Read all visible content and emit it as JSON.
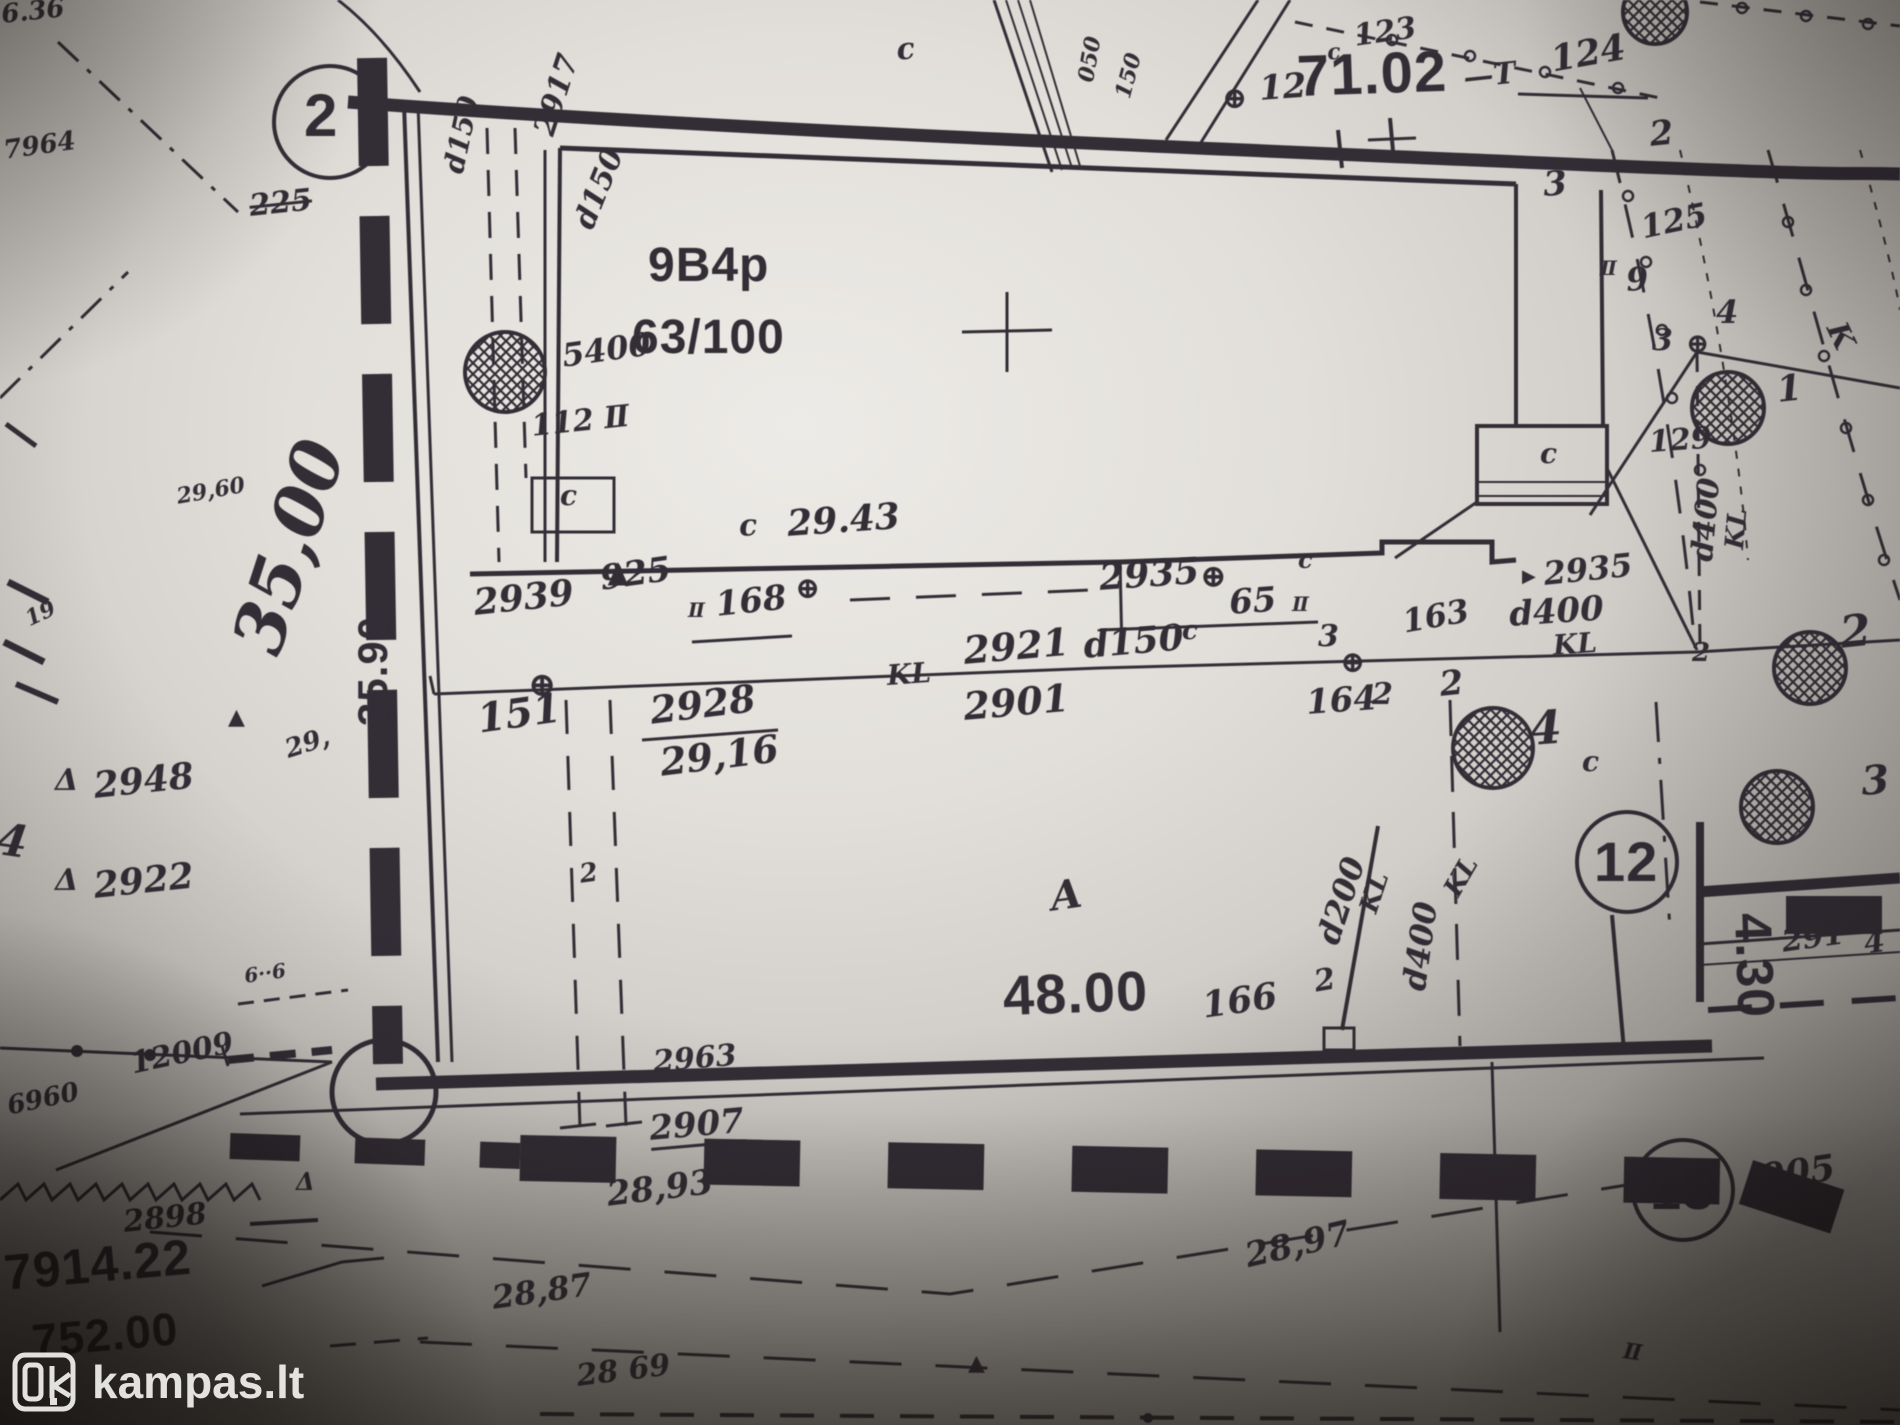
{
  "watermark": {
    "brand": "kampas.lt"
  },
  "map": {
    "labels": [
      {
        "name": "frag-top-left",
        "text": "6.36",
        "x": 0,
        "y": 2,
        "size": 26,
        "rot": -6,
        "cls": "h"
      },
      {
        "name": "frag-7964",
        "text": "7964",
        "x": 2,
        "y": 138,
        "size": 26,
        "rot": -8,
        "cls": "h"
      },
      {
        "name": "point-circle-2",
        "text": "2",
        "x": 304,
        "y": 86,
        "size": 60,
        "rot": 0,
        "cls": "p"
      },
      {
        "name": "scribble-225",
        "text": "225",
        "x": 248,
        "y": 192,
        "size": 30,
        "rot": -6,
        "cls": "h strike"
      },
      {
        "name": "pipe-d150-a",
        "text": "d150",
        "x": 440,
        "y": 170,
        "size": 28,
        "rot": -78,
        "cls": "h"
      },
      {
        "name": "pipe-d150-b",
        "text": "d150",
        "x": 570,
        "y": 222,
        "size": 30,
        "rot": -68,
        "cls": "h"
      },
      {
        "name": "mark-2917",
        "text": "2917",
        "x": 530,
        "y": 130,
        "size": 30,
        "rot": -72,
        "cls": "h"
      },
      {
        "name": "mark-5400",
        "text": "5400",
        "x": 560,
        "y": 340,
        "size": 32,
        "rot": -8,
        "cls": "h"
      },
      {
        "name": "mark-112",
        "text": "112 Ⅱ",
        "x": 530,
        "y": 412,
        "size": 30,
        "rot": -6,
        "cls": "h"
      },
      {
        "name": "shed-c",
        "text": "c",
        "x": 560,
        "y": 482,
        "size": 28,
        "rot": 0,
        "cls": "h"
      },
      {
        "name": "parcel-code",
        "text": "9B4p",
        "x": 648,
        "y": 242,
        "size": 48,
        "rot": 0,
        "cls": "p"
      },
      {
        "name": "parcel-share",
        "text": "63/100",
        "x": 632,
        "y": 314,
        "size": 48,
        "rot": 0,
        "cls": "p"
      },
      {
        "name": "mark-c-top",
        "text": "c",
        "x": 895,
        "y": 36,
        "size": 30,
        "rot": -6,
        "cls": "h"
      },
      {
        "name": "mark-c-123",
        "text": "c",
        "x": 1326,
        "y": 42,
        "size": 22,
        "rot": -6,
        "cls": "h"
      },
      {
        "name": "mark-123",
        "text": "123",
        "x": 1352,
        "y": 22,
        "size": 30,
        "rot": -8,
        "cls": "h"
      },
      {
        "name": "oplus-12",
        "text": "⊕",
        "x": 1222,
        "y": 84,
        "size": 30,
        "rot": 0,
        "cls": "h"
      },
      {
        "name": "mark-12-small",
        "text": "12",
        "x": 1258,
        "y": 72,
        "size": 34,
        "rot": -4,
        "cls": "h"
      },
      {
        "name": "elev-7102",
        "text": "71.02",
        "x": 1296,
        "y": 48,
        "size": 58,
        "rot": -2,
        "cls": "p"
      },
      {
        "name": "mark-dash-T",
        "text": "—T",
        "x": 1462,
        "y": 64,
        "size": 30,
        "rot": -6,
        "cls": "h"
      },
      {
        "name": "mark-124",
        "text": "124",
        "x": 1548,
        "y": 42,
        "size": 36,
        "rot": -10,
        "cls": "h"
      },
      {
        "name": "mark-2-tr",
        "text": "2",
        "x": 1648,
        "y": 118,
        "size": 34,
        "rot": -6,
        "cls": "h"
      },
      {
        "name": "mark-3-tr",
        "text": "3",
        "x": 1542,
        "y": 168,
        "size": 34,
        "rot": -4,
        "cls": "h"
      },
      {
        "name": "mark-125",
        "text": "125",
        "x": 1638,
        "y": 212,
        "size": 32,
        "rot": -12,
        "cls": "h"
      },
      {
        "name": "mark-ii-9",
        "text": "Ⅱ",
        "x": 1600,
        "y": 258,
        "size": 20,
        "rot": 0,
        "cls": "h"
      },
      {
        "name": "mark-9",
        "text": "9",
        "x": 1625,
        "y": 264,
        "size": 32,
        "rot": -4,
        "cls": "h"
      },
      {
        "name": "mark-4-r",
        "text": "4",
        "x": 1716,
        "y": 296,
        "size": 32,
        "rot": 0,
        "cls": "h"
      },
      {
        "name": "mark-3-r",
        "text": "3",
        "x": 1652,
        "y": 326,
        "size": 30,
        "rot": 0,
        "cls": "h"
      },
      {
        "name": "oplus-junction-r",
        "text": "⊕",
        "x": 1686,
        "y": 330,
        "size": 28,
        "rot": 0,
        "cls": "h"
      },
      {
        "name": "mark-1-r",
        "text": "1",
        "x": 1775,
        "y": 372,
        "size": 36,
        "rot": -6,
        "cls": "h"
      },
      {
        "name": "mark-K-r",
        "text": "K",
        "x": 1848,
        "y": 318,
        "size": 30,
        "rot": 65,
        "cls": "h"
      },
      {
        "name": "mark-129",
        "text": "129",
        "x": 1648,
        "y": 428,
        "size": 30,
        "rot": -4,
        "cls": "h"
      },
      {
        "name": "annex-c",
        "text": "c",
        "x": 1540,
        "y": 440,
        "size": 28,
        "rot": 0,
        "cls": "h"
      },
      {
        "name": "mark-2939",
        "text": "2939",
        "x": 472,
        "y": 585,
        "size": 36,
        "rot": -6,
        "cls": "h"
      },
      {
        "name": "mark-925",
        "text": "925",
        "x": 598,
        "y": 562,
        "size": 34,
        "rot": -8,
        "cls": "h"
      },
      {
        "name": "mark-ii-168",
        "text": "Ⅱ",
        "x": 688,
        "y": 600,
        "size": 20,
        "rot": 0,
        "cls": "h"
      },
      {
        "name": "mark-168",
        "text": "168",
        "x": 714,
        "y": 588,
        "size": 34,
        "rot": -6,
        "cls": "h"
      },
      {
        "name": "oplus-a",
        "text": "⊕",
        "x": 795,
        "y": 574,
        "size": 30,
        "rot": 0,
        "cls": "h"
      },
      {
        "name": "mark-2935-c",
        "text": "2935",
        "x": 1098,
        "y": 560,
        "size": 36,
        "rot": -4,
        "cls": "h"
      },
      {
        "name": "oplus-b",
        "text": "⊕",
        "x": 1200,
        "y": 560,
        "size": 32,
        "rot": 0,
        "cls": "h"
      },
      {
        "name": "mark-65",
        "text": "65",
        "x": 1228,
        "y": 586,
        "size": 34,
        "rot": -4,
        "cls": "h"
      },
      {
        "name": "mark-ii-65",
        "text": "Ⅱ",
        "x": 1292,
        "y": 594,
        "size": 20,
        "rot": 0,
        "cls": "h"
      },
      {
        "name": "mark-c-65",
        "text": "c",
        "x": 1298,
        "y": 548,
        "size": 24,
        "rot": 0,
        "cls": "h"
      },
      {
        "name": "dim-c-2943",
        "text": "c",
        "x": 738,
        "y": 512,
        "size": 30,
        "rot": -4,
        "cls": "h"
      },
      {
        "name": "dim-2943",
        "text": "29.43",
        "x": 786,
        "y": 506,
        "size": 36,
        "rot": -4,
        "cls": "h"
      },
      {
        "name": "mark-2921",
        "text": "2921",
        "x": 962,
        "y": 632,
        "size": 38,
        "rot": -5,
        "cls": "h"
      },
      {
        "name": "pipe-d150-c",
        "text": "d150",
        "x": 1082,
        "y": 628,
        "size": 36,
        "rot": -5,
        "cls": "h"
      },
      {
        "name": "mark-c-2921",
        "text": "c",
        "x": 1182,
        "y": 618,
        "size": 26,
        "rot": 0,
        "cls": "h"
      },
      {
        "name": "mark-KL-a",
        "text": "KL",
        "x": 886,
        "y": 662,
        "size": 28,
        "rot": -4,
        "cls": "h"
      },
      {
        "name": "mark-2901",
        "text": "2901",
        "x": 962,
        "y": 688,
        "size": 38,
        "rot": -5,
        "cls": "h"
      },
      {
        "name": "mark-3-kl",
        "text": "3",
        "x": 1318,
        "y": 622,
        "size": 30,
        "rot": 0,
        "cls": "h"
      },
      {
        "name": "oplus-c",
        "text": "⊕",
        "x": 1340,
        "y": 648,
        "size": 30,
        "rot": 0,
        "cls": "h"
      },
      {
        "name": "mark-164",
        "text": "164",
        "x": 1305,
        "y": 686,
        "size": 34,
        "rot": -4,
        "cls": "h"
      },
      {
        "name": "mark-2-164",
        "text": "2",
        "x": 1372,
        "y": 680,
        "size": 30,
        "rot": 0,
        "cls": "h"
      },
      {
        "name": "mark-163",
        "text": "163",
        "x": 1400,
        "y": 606,
        "size": 32,
        "rot": -10,
        "cls": "h"
      },
      {
        "name": "tri-2935",
        "text": "▶",
        "x": 1522,
        "y": 568,
        "size": 18,
        "rot": 0,
        "cls": "h"
      },
      {
        "name": "mark-2935-r",
        "text": "2935",
        "x": 1542,
        "y": 558,
        "size": 32,
        "rot": -6,
        "cls": "h"
      },
      {
        "name": "pipe-d400-r",
        "text": "d400",
        "x": 1508,
        "y": 598,
        "size": 34,
        "rot": -4,
        "cls": "h"
      },
      {
        "name": "mark-KL-b",
        "text": "KL",
        "x": 1552,
        "y": 632,
        "size": 28,
        "rot": -4,
        "cls": "h"
      },
      {
        "name": "mark-2-kl",
        "text": "2",
        "x": 1692,
        "y": 640,
        "size": 26,
        "rot": 0,
        "cls": "h"
      },
      {
        "name": "mark-2-big-r",
        "text": "2",
        "x": 1838,
        "y": 612,
        "size": 44,
        "rot": -6,
        "cls": "h"
      },
      {
        "name": "pipe-d400-rot",
        "text": "d400",
        "x": 1688,
        "y": 560,
        "size": 30,
        "rot": -85,
        "cls": "h"
      },
      {
        "name": "mark-KL-rot",
        "text": "KL",
        "x": 1722,
        "y": 548,
        "size": 26,
        "rot": -85,
        "cls": "h"
      },
      {
        "name": "mark-151",
        "text": "151",
        "x": 475,
        "y": 700,
        "size": 40,
        "rot": -8,
        "cls": "h"
      },
      {
        "name": "mark-2928",
        "text": "2928",
        "x": 648,
        "y": 692,
        "size": 38,
        "rot": -7,
        "cls": "h"
      },
      {
        "name": "mark-2916",
        "text": "29,16",
        "x": 658,
        "y": 744,
        "size": 38,
        "rot": -7,
        "cls": "h"
      },
      {
        "name": "dim-3500-hand",
        "text": "35,00",
        "x": 222,
        "y": 640,
        "size": 70,
        "rot": -72,
        "cls": "h"
      },
      {
        "name": "mark-2960",
        "text": "29,60",
        "x": 175,
        "y": 486,
        "size": 22,
        "rot": -10,
        "cls": "h"
      },
      {
        "name": "mark-29",
        "text": "29,",
        "x": 282,
        "y": 738,
        "size": 26,
        "rot": -18,
        "cls": "h"
      },
      {
        "name": "tri-a",
        "text": "▲",
        "x": 228,
        "y": 706,
        "size": 22,
        "rot": 0,
        "cls": "h"
      },
      {
        "name": "delta-2948",
        "text": "Δ",
        "x": 55,
        "y": 766,
        "size": 30,
        "rot": 0,
        "cls": "h"
      },
      {
        "name": "mark-2948",
        "text": "2948",
        "x": 92,
        "y": 768,
        "size": 36,
        "rot": -6,
        "cls": "h"
      },
      {
        "name": "delta-2922",
        "text": "Δ",
        "x": 55,
        "y": 866,
        "size": 30,
        "rot": 0,
        "cls": "h"
      },
      {
        "name": "mark-2922",
        "text": "2922",
        "x": 92,
        "y": 868,
        "size": 36,
        "rot": -6,
        "cls": "h"
      },
      {
        "name": "mark-19",
        "text": "19",
        "x": 22,
        "y": 610,
        "size": 22,
        "rot": -25,
        "cls": "h"
      },
      {
        "name": "scribble-4-edge",
        "text": "4",
        "x": 0,
        "y": 818,
        "size": 44,
        "rot": 8,
        "cls": "h"
      },
      {
        "name": "dim-3590-print",
        "text": "35.90",
        "x": 352,
        "y": 726,
        "size": 42,
        "rot": -90,
        "cls": "p"
      },
      {
        "name": "zone-A",
        "text": "A",
        "x": 1048,
        "y": 878,
        "size": 40,
        "rot": -8,
        "cls": "h"
      },
      {
        "name": "dim-4800",
        "text": "48.00",
        "x": 1002,
        "y": 968,
        "size": 56,
        "rot": -2,
        "cls": "p"
      },
      {
        "name": "mark-166",
        "text": "166",
        "x": 1200,
        "y": 988,
        "size": 36,
        "rot": -8,
        "cls": "h"
      },
      {
        "name": "mark-2-166",
        "text": "2",
        "x": 1312,
        "y": 968,
        "size": 30,
        "rot": -10,
        "cls": "h"
      },
      {
        "name": "pipe-d200-rot",
        "text": "d200",
        "x": 1312,
        "y": 938,
        "size": 32,
        "rot": -72,
        "cls": "h"
      },
      {
        "name": "mark-KL-rot-c",
        "text": "KL",
        "x": 1356,
        "y": 908,
        "size": 26,
        "rot": -72,
        "cls": "h"
      },
      {
        "name": "pipe-d400-rot2",
        "text": "d400",
        "x": 1398,
        "y": 988,
        "size": 32,
        "rot": -82,
        "cls": "h"
      },
      {
        "name": "mark-KL-rot-d",
        "text": "KL",
        "x": 1440,
        "y": 888,
        "size": 26,
        "rot": -60,
        "cls": "h"
      },
      {
        "name": "mark-2963",
        "text": "2963",
        "x": 652,
        "y": 1048,
        "size": 30,
        "rot": -5,
        "cls": "h"
      },
      {
        "name": "mark-2907",
        "text": "2907",
        "x": 648,
        "y": 1112,
        "size": 34,
        "rot": -5,
        "cls": "h ul"
      },
      {
        "name": "mark-2893",
        "text": "28,93",
        "x": 605,
        "y": 1178,
        "size": 34,
        "rot": -7,
        "cls": "h"
      },
      {
        "name": "mark-2897",
        "text": "28,97",
        "x": 1242,
        "y": 1240,
        "size": 34,
        "rot": -13,
        "cls": "h"
      },
      {
        "name": "mark-12009",
        "text": "12009",
        "x": 128,
        "y": 1050,
        "size": 30,
        "rot": -12,
        "cls": "h"
      },
      {
        "name": "mark-6960",
        "text": "6960",
        "x": 5,
        "y": 1094,
        "size": 26,
        "rot": -12,
        "cls": "h"
      },
      {
        "name": "mark-2898",
        "text": "2898",
        "x": 122,
        "y": 1208,
        "size": 30,
        "rot": -6,
        "cls": "h"
      },
      {
        "name": "mark-791422",
        "text": "7914.22",
        "x": 2,
        "y": 1248,
        "size": 50,
        "rot": -5,
        "cls": "p"
      },
      {
        "name": "mark-75200",
        "text": "752.00",
        "x": 30,
        "y": 1318,
        "size": 46,
        "rot": -5,
        "cls": "p"
      },
      {
        "name": "mark-2887",
        "text": "28,87",
        "x": 490,
        "y": 1282,
        "size": 32,
        "rot": -8,
        "cls": "h"
      },
      {
        "name": "mark-2869",
        "text": "28 69",
        "x": 575,
        "y": 1362,
        "size": 30,
        "rot": -7,
        "cls": "h"
      },
      {
        "name": "tri-b",
        "text": "▲",
        "x": 968,
        "y": 1352,
        "size": 22,
        "rot": 0,
        "cls": "h"
      },
      {
        "name": "mark-ii-bottom",
        "text": "Ⅱ",
        "x": 1625,
        "y": 1340,
        "size": 22,
        "rot": 8,
        "cls": "h"
      },
      {
        "name": "point-circle-12",
        "text": "12",
        "x": 1594,
        "y": 834,
        "size": 56,
        "rot": 0,
        "cls": "p"
      },
      {
        "name": "point-circle-13",
        "text": "13",
        "x": 1650,
        "y": 1162,
        "size": 56,
        "rot": 0,
        "cls": "p"
      },
      {
        "name": "mark-905",
        "text": "905",
        "x": 1758,
        "y": 1160,
        "size": 36,
        "rot": -8,
        "cls": "h"
      },
      {
        "name": "dim-430",
        "text": "4.30",
        "x": 1778,
        "y": 912,
        "size": 52,
        "rot": 88,
        "cls": "p"
      },
      {
        "name": "mark-291",
        "text": "291",
        "x": 1780,
        "y": 928,
        "size": 30,
        "rot": -8,
        "cls": "h"
      },
      {
        "name": "mark-4-291",
        "text": "4",
        "x": 1862,
        "y": 930,
        "size": 30,
        "rot": -8,
        "cls": "h"
      },
      {
        "name": "mark-3-br",
        "text": "3",
        "x": 1860,
        "y": 762,
        "size": 40,
        "rot": -4,
        "cls": "h"
      },
      {
        "name": "mark-c-12",
        "text": "c",
        "x": 1582,
        "y": 748,
        "size": 28,
        "rot": 0,
        "cls": "h"
      },
      {
        "name": "mark-4-12",
        "text": "4",
        "x": 1528,
        "y": 706,
        "size": 46,
        "rot": -4,
        "cls": "h"
      },
      {
        "name": "mark-2-163",
        "text": "2",
        "x": 1438,
        "y": 668,
        "size": 34,
        "rot": -6,
        "cls": "h"
      },
      {
        "name": "oplus-e",
        "text": "⊕",
        "x": 528,
        "y": 668,
        "size": 34,
        "rot": 0,
        "cls": "h"
      },
      {
        "name": "mark-2-pipe",
        "text": "2",
        "x": 578,
        "y": 862,
        "size": 26,
        "rot": -8,
        "cls": "h"
      },
      {
        "name": "rot-050",
        "text": "050",
        "x": 1075,
        "y": 80,
        "size": 22,
        "rot": -80,
        "cls": "h"
      },
      {
        "name": "rot-150",
        "text": "150",
        "x": 1112,
        "y": 95,
        "size": 22,
        "rot": -75,
        "cls": "h"
      },
      {
        "name": "fence-6-6",
        "text": "6··6",
        "x": 243,
        "y": 966,
        "size": 20,
        "rot": -8,
        "cls": "h"
      },
      {
        "name": "delta-zigzag",
        "text": "Δ",
        "x": 296,
        "y": 1170,
        "size": 24,
        "rot": 0,
        "cls": "h"
      }
    ]
  }
}
